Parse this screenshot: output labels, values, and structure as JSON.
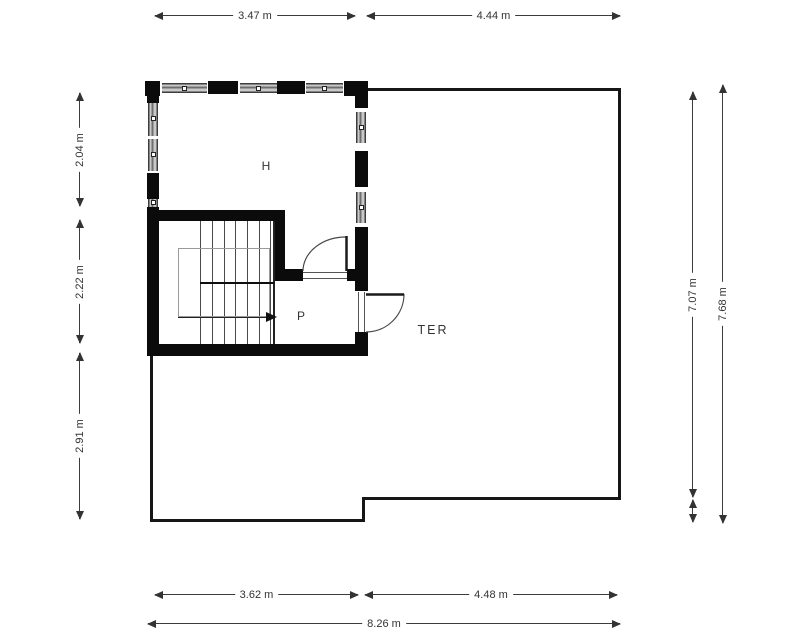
{
  "rooms": {
    "h": "H",
    "p": "P",
    "ter": "TER"
  },
  "dims": {
    "top": [
      "3.47 m",
      "4.44 m"
    ],
    "left": [
      "2.04 m",
      "2.22 m",
      "2.91 m"
    ],
    "right": [
      "7.07 m",
      "7.68 m"
    ],
    "bottom": [
      "3.62 m",
      "4.48 m",
      "8.26 m"
    ]
  },
  "colors": {
    "wall": "#0b0b0b",
    "window_fill": "#c9c9c9",
    "dimension": "#333333",
    "background": "#ffffff"
  }
}
